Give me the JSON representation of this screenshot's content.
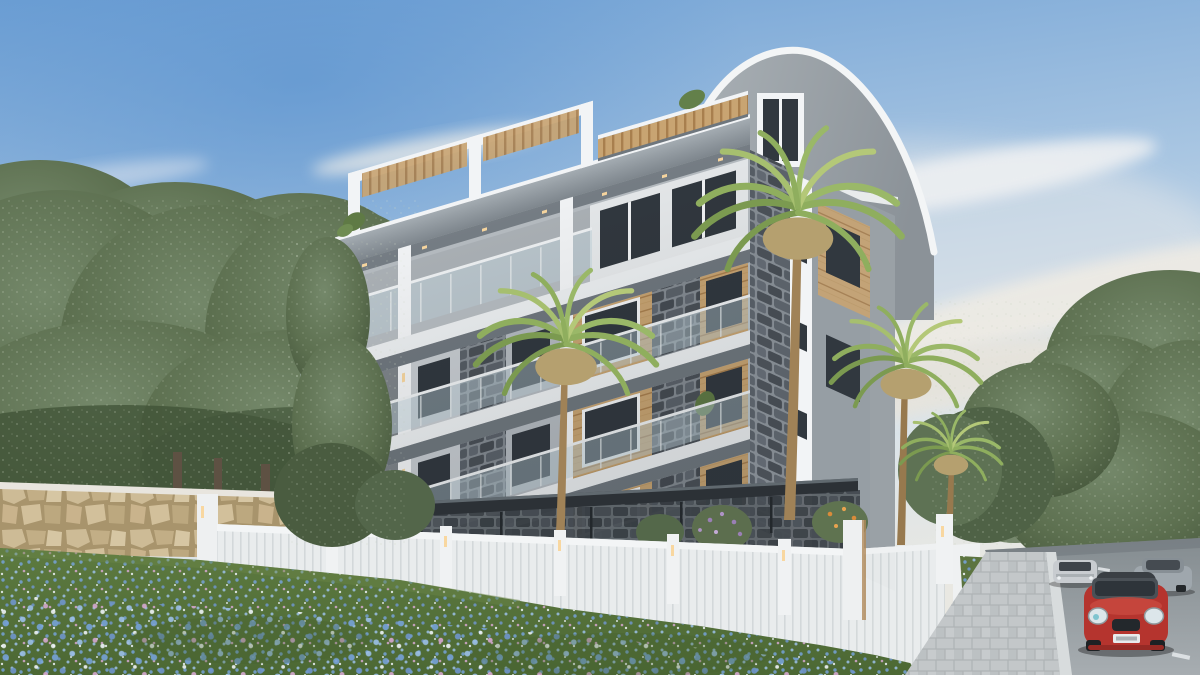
{
  "scene": {
    "type": "architectural-exterior-render",
    "setting": "new 5-storey apartment building among dense green trees, flower meadow in foreground, street with cars at right",
    "sky": {
      "condition": "clear with wispy clouds",
      "time": "day"
    },
    "building": {
      "floors_visible": 5,
      "roof": "barrel-arch end + flat roof terrace with wood pergolas",
      "materials": [
        "white concrete",
        "gray slate stone cladding",
        "wood paneling",
        "glass balustrades"
      ],
      "features": [
        "roof terrace pergola frame",
        "arched gable window",
        "cantilevered balconies",
        "warm facade downlights",
        "dark glass entrance canopy"
      ]
    },
    "site": {
      "front_wall": "beige natural stone retaining wall with white cap",
      "fence": "white ribbed panel fence with lit pillars",
      "meadow": "green lawn densely covered with blue, white and pink flowers",
      "sidewalk": "gray paver walkway",
      "road": "asphalt street with white lane dashes"
    },
    "vegetation": {
      "left": "dense deciduous tree row with visible trunks",
      "right": "tree masses along street",
      "palms": 4,
      "bushes": [
        "purple flowering",
        "orange flowering"
      ]
    },
    "vehicles": [
      {
        "type": "hatchback",
        "color": "red",
        "view": "front",
        "position": "foreground right lane"
      },
      {
        "type": "sedan",
        "color": "silver",
        "view": "front",
        "position": "middle distance left lane"
      },
      {
        "type": "sedan",
        "color": "gray",
        "view": "front-quarter",
        "position": "middle distance right lane"
      }
    ]
  },
  "palette": {
    "skyTop": "#6d9fd4",
    "skyMid": "#a9c6e2",
    "skyLow": "#d9e3ea",
    "skyHorizon": "#e9e8e2",
    "cloud": "#f2efe7",
    "treeDark": "#3f5136",
    "treeMid": "#5d7050",
    "treeLight": "#74886a",
    "treeSpeckle": "#ccd6c2",
    "treeTrunk": "#5e5143",
    "bldWhite": "#f2f4f6",
    "slabWhite": "#eceff1",
    "slabUnder": "#6f777e",
    "fasciaGray": "#99a1a8",
    "wallGray": "#b6bcc1",
    "roofGray": "#9aa1a7",
    "stoneDark": "#4a5057",
    "stoneMortar": "#848b92",
    "wood": "#c8a472",
    "woodDark": "#a87f4e",
    "glassDark": "#31383f",
    "balconyGlass": "#bdd0d9",
    "railWhite": "#eef1f3",
    "warmLight": "#f8d7a0",
    "wallStone": "#c4b28c",
    "wallStoneLight": "#d6c6a3",
    "wallStoneDark": "#a8946c",
    "fenceWhite": "#e9eced",
    "fenceRib": "#d3d8da",
    "meadowGreen": "#57743c",
    "meadowDark": "#46602f",
    "flowerBlue": "#76a2d8",
    "flowerLightBlue": "#9cc0e8",
    "flowerPink": "#d5a8d0",
    "flowerWhite": "#eef3f8",
    "sidewalk": "#c2c6c8",
    "curb": "#d8dcdd",
    "road": "#8f979b",
    "laneDash": "#e6eaec",
    "carRed": "#b5342e",
    "carSilver": "#c8ccd0",
    "carGray": "#9fa7ad",
    "palmGreen": "#8fae5e",
    "palmLight": "#b4c878",
    "palmDry": "#b5a06f",
    "palmTrunk": "#a08257",
    "bushPurple": "#9a7fb5",
    "bushOrange": "#d98b3a"
  }
}
